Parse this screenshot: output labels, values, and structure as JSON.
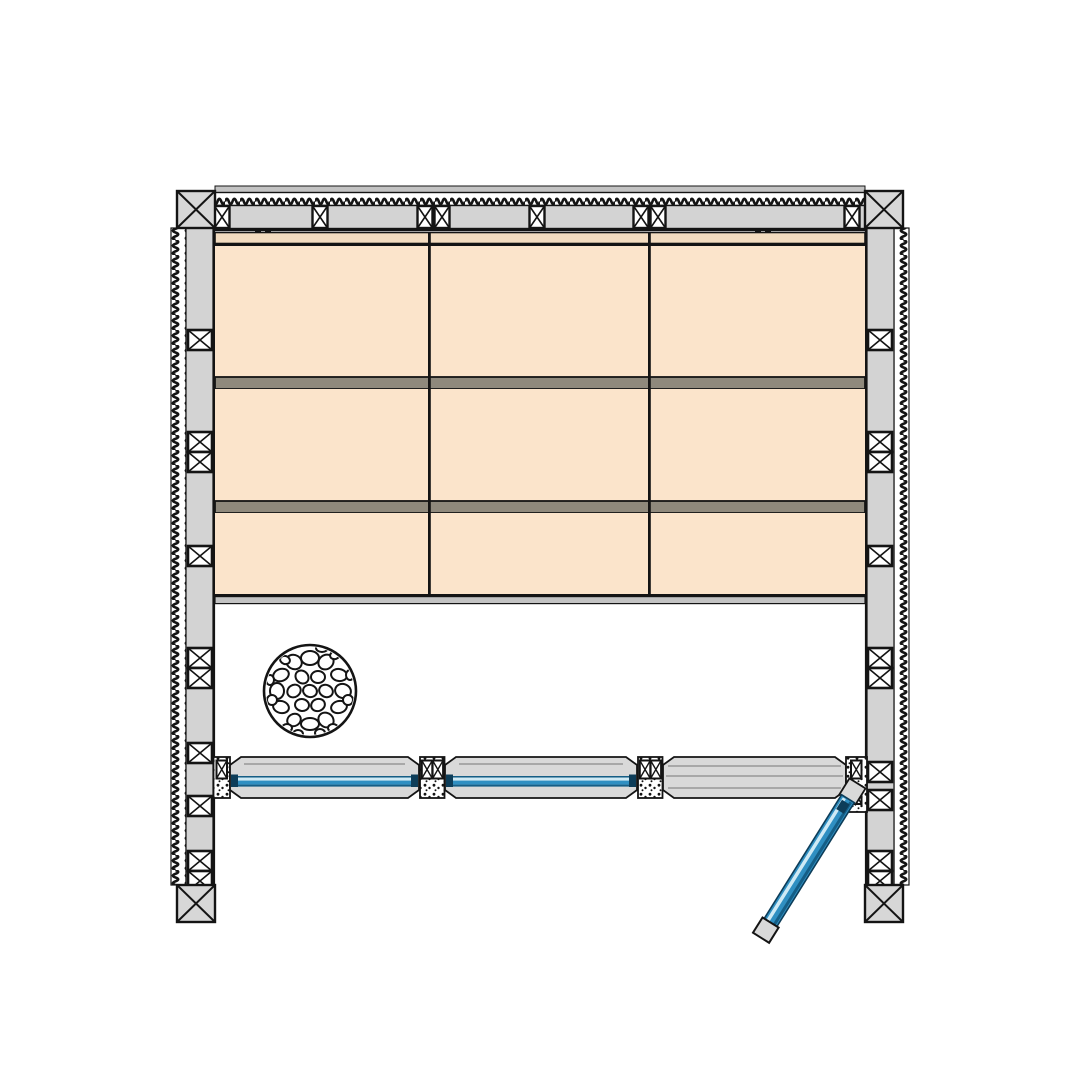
{
  "drawing": {
    "kind": "floor-plan-detail-drawing",
    "subject": "room plan with panelled walls, stone heater, glazed front wall and open glass door",
    "text_labels": [],
    "panel_grid": {
      "rows": 3,
      "columns": 3
    },
    "corner_posts": 4,
    "glazed_front_panels": 2,
    "doors": 1,
    "door_state": "open",
    "heater_shape": "circle-with-stones"
  },
  "palette": {
    "background": "#ffffff",
    "outline": "#141414",
    "wall_gray": "#d3d3d3",
    "wall_gray_dark": "#c3c3c3",
    "post_gray": "#d7d7d7",
    "panel_peach": "#fbe4cb",
    "trim_tan": "#f3dcc0",
    "rail_gray": "#8f897c",
    "frame_gray": "#d9d9d9",
    "detail_gray": "#8a8a8a",
    "glass_blue": "#2f8fc2",
    "glass_blue_dark": "#155e86",
    "glass_blue_deep": "#0d3d59",
    "glass_blue_light": "#cfeaf5",
    "stone_white": "#ffffff"
  }
}
